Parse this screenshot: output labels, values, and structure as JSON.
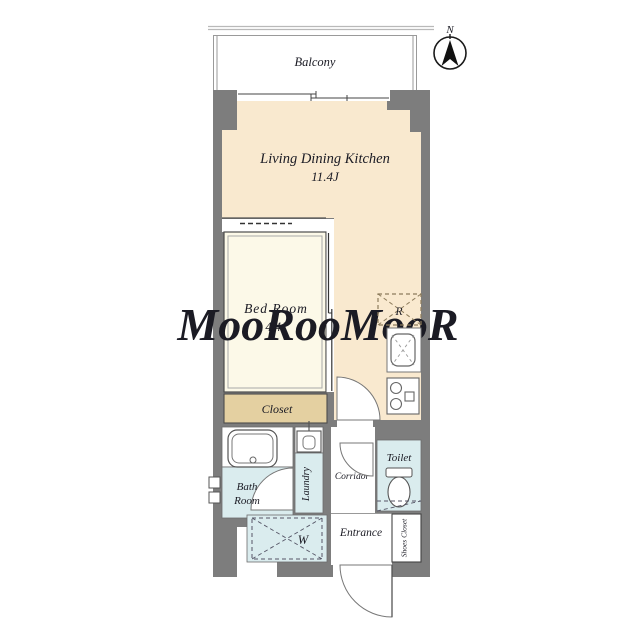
{
  "plan": {
    "compass": {
      "north_label": "N"
    },
    "balcony": {
      "label": "Balcony"
    },
    "ldk": {
      "label": "Living Dining Kitchen",
      "area": "11.4J"
    },
    "bedroom": {
      "label": "Bed Room",
      "area": "4.4J"
    },
    "closet": {
      "label": "Closet"
    },
    "bathroom": {
      "label_line1": "Bath",
      "label_line2": "Room"
    },
    "laundry": {
      "label": "Laundry"
    },
    "washer": {
      "symbol": "W"
    },
    "fridge": {
      "symbol": "R"
    },
    "corridor": {
      "label": "Corridor"
    },
    "toilet": {
      "label": "Toilet"
    },
    "entrance": {
      "label": "Entrance"
    },
    "shoe_closet": {
      "label": "Shoes Closet"
    },
    "watermark": "MooRooMooR",
    "colors": {
      "wall": "#7d7d7d",
      "ldk_fill": "#f9e9cf",
      "bedroom_fill": "#fcf9e8",
      "closet_fill": "#e4d0a1",
      "wet_area_fill": "#daecee",
      "accent_line": "#b9b9b9",
      "outline": "#555555"
    }
  }
}
